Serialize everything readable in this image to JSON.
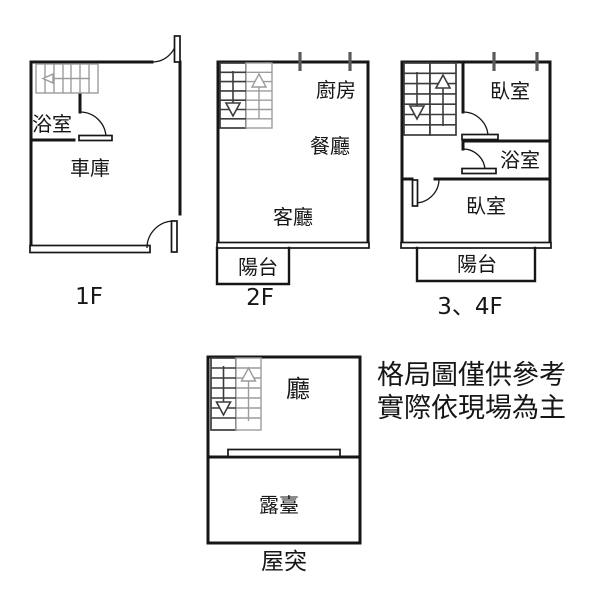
{
  "disclaimer": {
    "line1": "格局圖僅供參考",
    "line2": "實際依現場為主"
  },
  "floors": {
    "f1": {
      "label": "1F",
      "rooms": {
        "bathroom": "浴室",
        "garage": "車庫"
      }
    },
    "f2": {
      "label": "2F",
      "rooms": {
        "kitchen": "廚房",
        "dining_room": "餐廳",
        "living_room": "客廳",
        "balcony": "陽台"
      }
    },
    "f34": {
      "label": "3、4F",
      "rooms": {
        "bedroom_upper": "臥室",
        "bathroom": "浴室",
        "bedroom_lower": "臥室",
        "balcony": "陽台"
      }
    },
    "roof": {
      "label": "屋突",
      "rooms": {
        "hall": "廳",
        "terrace": "露臺"
      }
    }
  },
  "colors": {
    "background": "#ffffff",
    "wall_line": "#161616",
    "stair_dark": "#3c3c3c",
    "stair_light": "#9c9c9c",
    "window_tick": "#5a5a5a"
  }
}
